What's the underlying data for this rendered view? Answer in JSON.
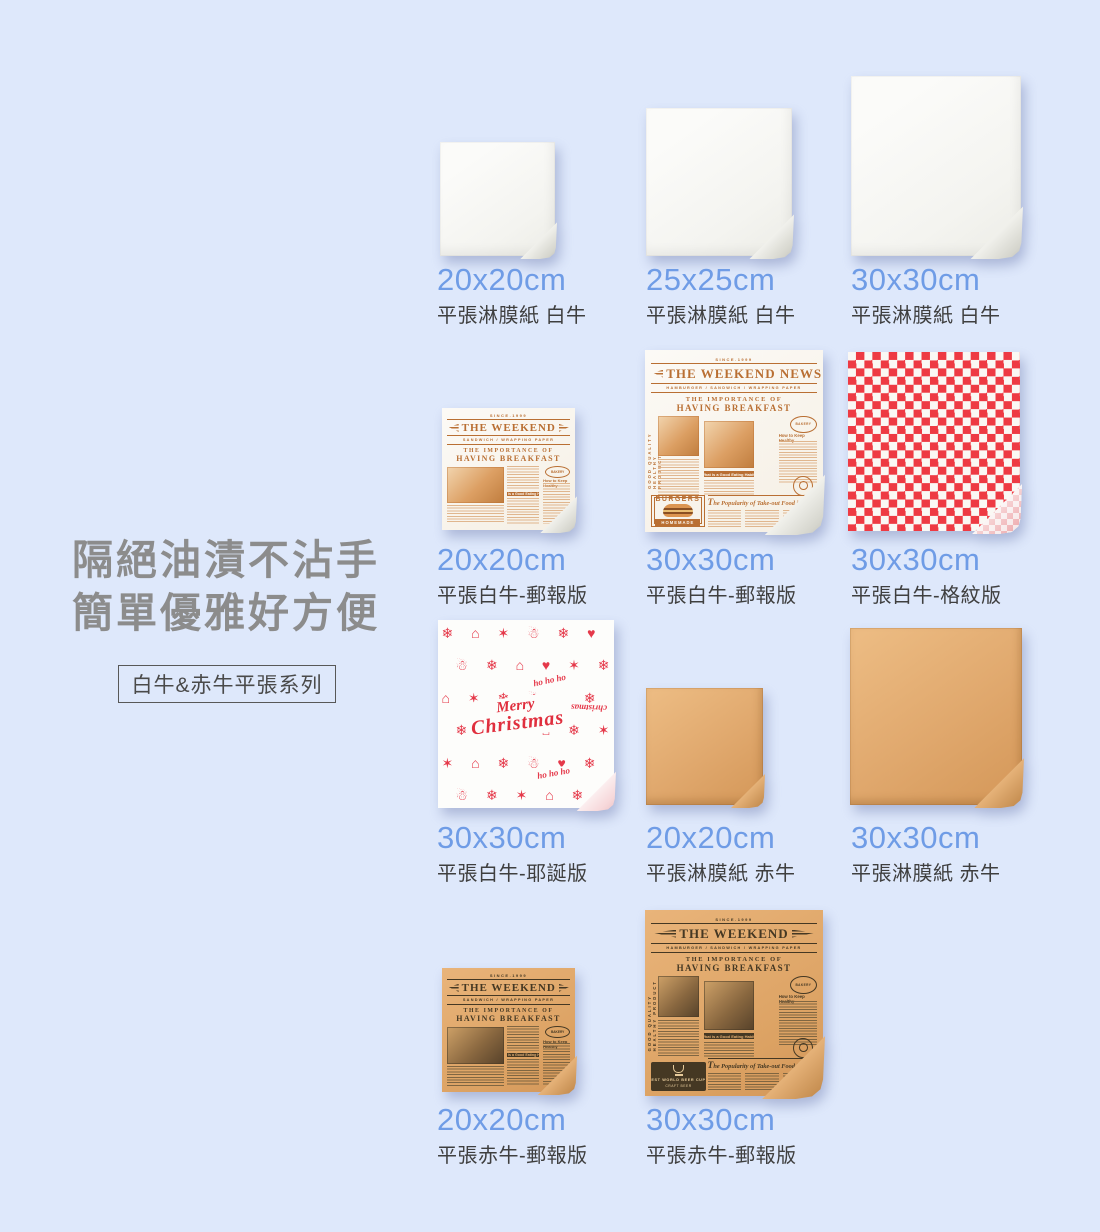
{
  "intro": {
    "headline_line1": "隔絕油漬不沾手",
    "headline_line2": "簡單優雅好方便",
    "series_badge": "白牛&赤牛平張系列"
  },
  "colors": {
    "background": "#dee8fb",
    "accent_blue": "#6f9ce6",
    "headline_gray": "#8c8c8c",
    "checker_red": "#ee3a43",
    "kraft_tan": "#e0a86d",
    "news_ink_white_version": "#b96f33",
    "news_ink_kraft_version": "#453823",
    "xmas_red": "#e5394a"
  },
  "products": [
    {
      "size": "20x20cm",
      "desc": "平張淋膜紙 白牛"
    },
    {
      "size": "25x25cm",
      "desc": "平張淋膜紙 白牛"
    },
    {
      "size": "30x30cm",
      "desc": "平張淋膜紙 白牛"
    },
    {
      "size": "20x20cm",
      "desc": "平張白牛-郵報版"
    },
    {
      "size": "30x30cm",
      "desc": "平張白牛-郵報版"
    },
    {
      "size": "30x30cm",
      "desc": "平張白牛-格紋版"
    },
    {
      "size": "30x30cm",
      "desc": "平張白牛-耶誕版"
    },
    {
      "size": "20x20cm",
      "desc": "平張淋膜紙 赤牛"
    },
    {
      "size": "30x30cm",
      "desc": "平張淋膜紙 赤牛"
    },
    {
      "size": "20x20cm",
      "desc": "平張赤牛-郵報版"
    },
    {
      "size": "30x30cm",
      "desc": "平張赤牛-郵報版"
    }
  ],
  "newspaper": {
    "since": "SINCE.1999",
    "masthead": "THE WEEKEND",
    "masthead_news": "THE WEEKEND NEWS",
    "subtitle": "SANDWICH / WRAPPING PAPER",
    "subtitle_long": "HAMBURGER / SANDWICH / WRAPPING PAPER",
    "headline_top": "THE IMPORTANCE OF",
    "headline_main": "HAVING BREAKFAST",
    "note_bar": "What is a Good Eating Habit?",
    "column_head": "How to Keep Healthy",
    "stamp": "BAKERY",
    "feature": "The Popularity of Take-out Food in School",
    "burgers_badge": {
      "top": "BURGERS",
      "ribbon": "HOMEMADE"
    },
    "trophy_badge": {
      "line1": "EST WORLD BEER CUP",
      "line2": "CRAFT BEER"
    },
    "side_text": "GOOD QUALITY HEALTHY PRODUCT"
  },
  "christmas": {
    "merry": "Merry",
    "christmas": "Christmas",
    "ho": "ho ho ho",
    "side_word": "christmas",
    "rows": [
      "❄ ⌂ ✶ ☃ ❄ ♥ ⌂",
      "☃ ❄ ⌂ ♥ ✶ ❄ ☃",
      "⌂ ✶ ❄ ☃ ⌂ ❄ ✶",
      "❄ ☃ ♥ ⌂ ❄ ✶ ☃",
      "✶ ⌂ ❄ ☃ ♥ ❄ ⌂",
      "☃ ❄ ✶ ⌂ ❄ ☃ ❄"
    ]
  }
}
